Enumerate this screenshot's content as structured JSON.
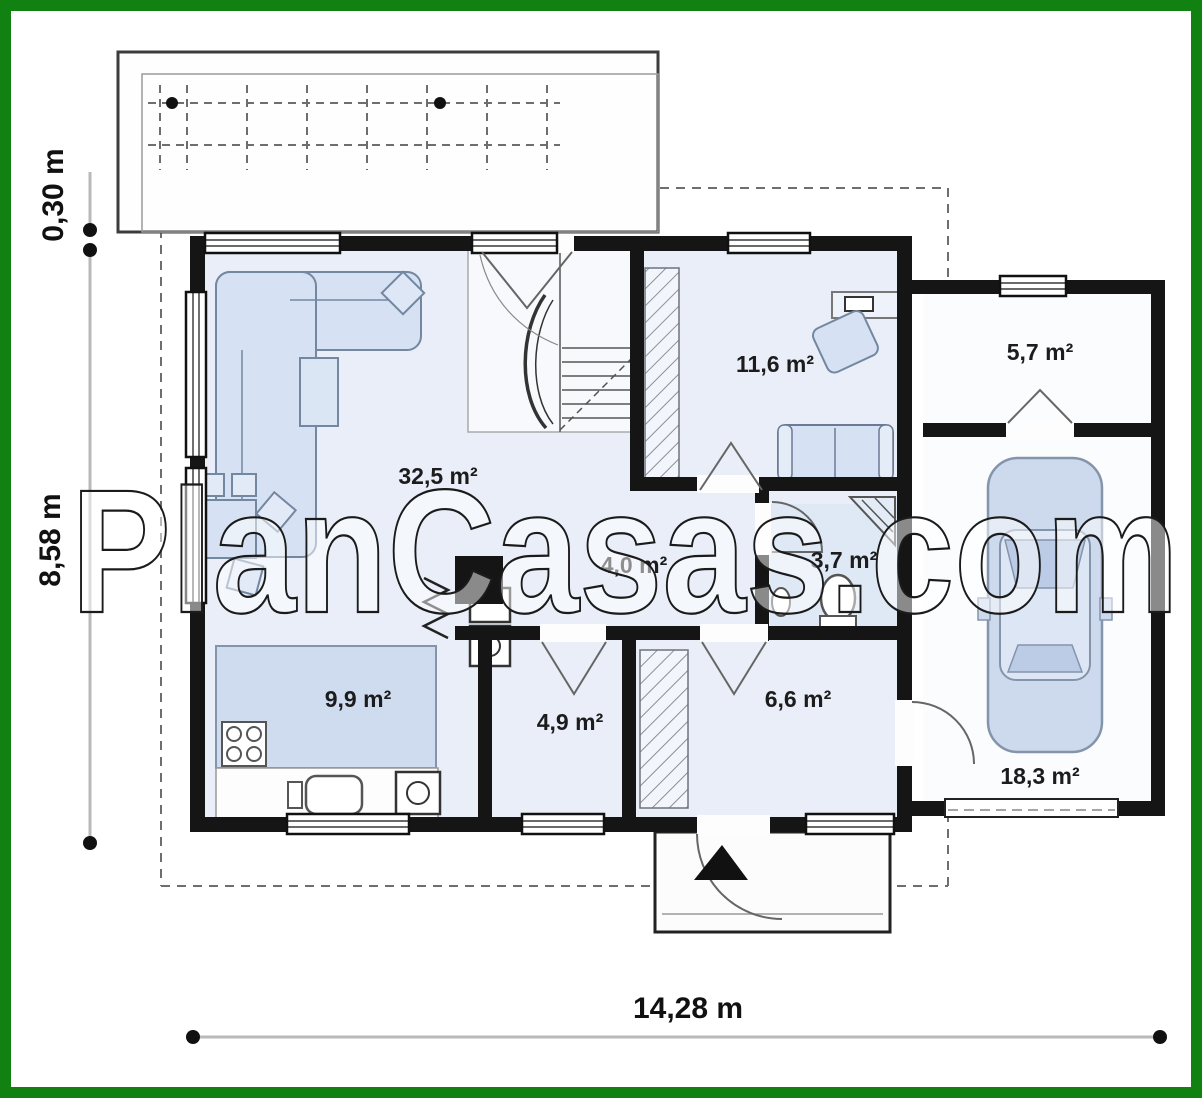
{
  "watermark": "PlanCasas.com",
  "dimensions": {
    "top_left": "0,30 m",
    "left": "8,58 m",
    "bottom": "14,28 m"
  },
  "rooms": {
    "living": "32,5 m²",
    "bedroom": "11,6 m²",
    "storage": "5,7 m²",
    "corridor": "4,0 m²",
    "bathroom": "3,7 m²",
    "kitchen": "9,9 m²",
    "utility": "4,9 m²",
    "hall": "6,6 m²",
    "garage": "18,3 m²"
  },
  "colors": {
    "frame_green": "#118211",
    "wall_black": "#151515",
    "room_fill": "#e9eef8",
    "furniture_fill": "#d6e2f3",
    "car_fill": "#cdd9ec"
  }
}
